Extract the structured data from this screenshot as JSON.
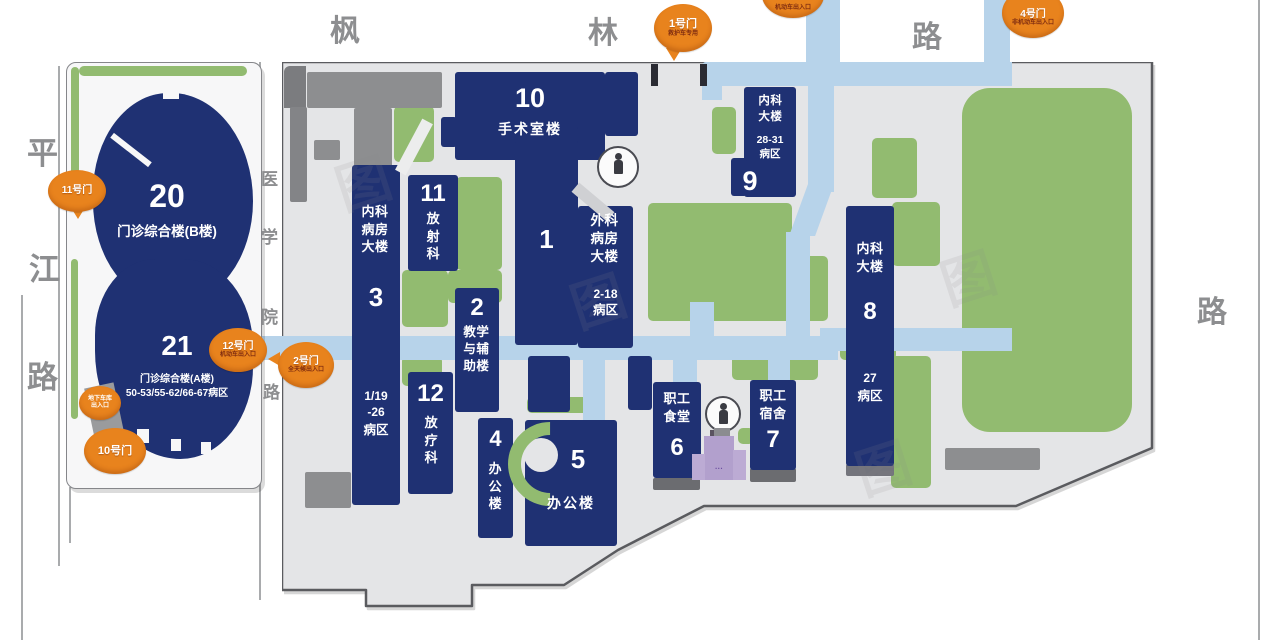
{
  "colors": {
    "building_navy": "#1f3173",
    "lawn_green": "#92bb70",
    "road_blue": "#b7d3ea",
    "gate_orange": "#e8831d",
    "campus_gray": "#e4e5e7",
    "purple_building": "#b2a0cd"
  },
  "roads": {
    "pingjiang": {
      "name": "平江路",
      "chars": [
        "平",
        "江",
        "路"
      ]
    },
    "fenglin": {
      "name": "枫林路",
      "chars": [
        "枫",
        "林",
        "路"
      ]
    },
    "yixueyuan": {
      "name": "医学院路",
      "chars": [
        "医",
        "学",
        "院",
        "路"
      ]
    },
    "right_road": {
      "chars": [
        "路"
      ]
    }
  },
  "gates": {
    "gate1": {
      "label": "1号门",
      "note": "救护车专用"
    },
    "gate2": {
      "label": "2号门",
      "note": "全天候出入口"
    },
    "gate3_partial": {
      "note": "机动车出入口"
    },
    "gate4": {
      "label": "4号门",
      "note": "非机动车出入口"
    },
    "gate10": {
      "label": "10号门"
    },
    "gate11": {
      "label": "11号门"
    },
    "gate12": {
      "label": "12号门",
      "note": "机动车出入口"
    },
    "garage": {
      "line1": "地下车库",
      "line2": "出入口"
    }
  },
  "buildings": {
    "b20": {
      "number": "20",
      "name": "门诊综合楼(B楼)"
    },
    "b21": {
      "number": "21",
      "name": "门诊综合楼(A楼)",
      "wards": "50-53/55-62/66-67病区"
    },
    "b10": {
      "number": "10",
      "name": "手术室楼"
    },
    "b11": {
      "number": "11",
      "name": "放射科"
    },
    "b3": {
      "number": "3",
      "name": "内科病房大楼",
      "wards1": "1/19",
      "wards2": "-26",
      "wards3": "病区"
    },
    "b2": {
      "number": "2",
      "name": "教学与辅助楼"
    },
    "b12": {
      "number": "12",
      "name": "放疗科"
    },
    "b1": {
      "number": "1"
    },
    "b1_panel": {
      "name": "外科病房大楼",
      "wards1": "2-18",
      "wards2": "病区"
    },
    "b9": {
      "number": "9",
      "name": "内科大楼",
      "wards1": "28-31",
      "wards2": "病区"
    },
    "b8": {
      "number": "8",
      "name": "内科大楼",
      "wards1": "27",
      "wards2": "病区"
    },
    "b4": {
      "number": "4",
      "name": "办公楼"
    },
    "b5": {
      "number": "5",
      "name": "办公楼"
    },
    "b6": {
      "number": "6",
      "name": "职工食堂"
    },
    "b7": {
      "number": "7",
      "name": "职工宿舍"
    },
    "purple": {
      "label": "···"
    }
  },
  "watermark": {
    "glyph": "图"
  }
}
